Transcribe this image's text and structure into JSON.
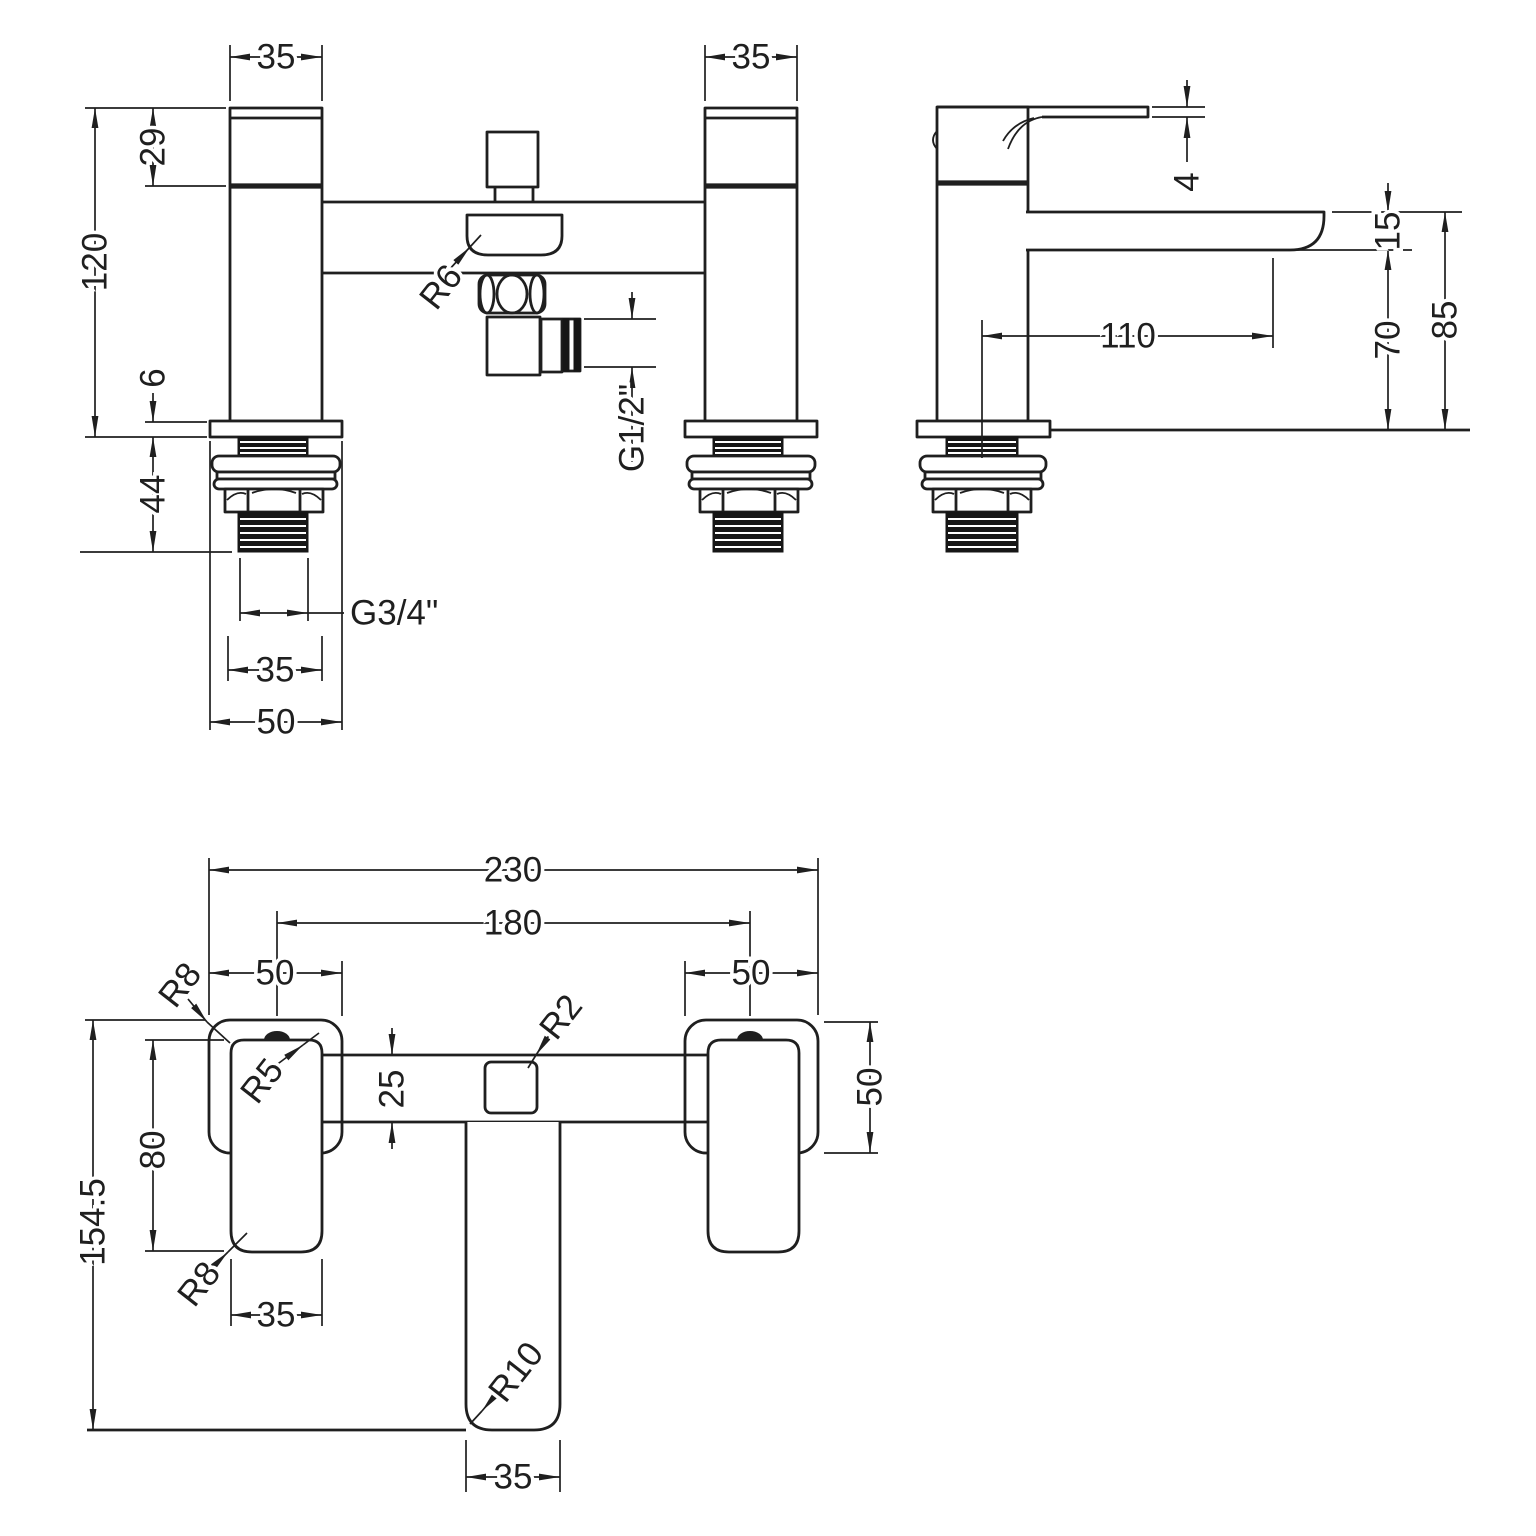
{
  "colors": {
    "line": "#1f1f1f",
    "background": "#ffffff"
  },
  "front_view": {
    "dim_left_body_width": "35",
    "dim_right_body_width": "35",
    "dim_handle_height": "29",
    "dim_height_to_deck": "120",
    "dim_deck_plate_thickness": "6",
    "dim_shank_length": "44",
    "shank_thread_label": "G3/4\"",
    "dim_shank_width": "35",
    "dim_flange_width": "50",
    "outlet_radius_label": "R6",
    "hose_thread_label": "G1/2\""
  },
  "side_view": {
    "dim_handle_thickness": "4",
    "dim_spout_thickness": "15",
    "dim_spout_reach": "110",
    "dim_spout_underside_height": "70",
    "dim_spout_top_height": "85"
  },
  "plan_view": {
    "dim_overall_width": "230",
    "dim_hole_centres": "180",
    "dim_left_escutcheon_width": "50",
    "dim_right_escutcheon_width": "50",
    "dim_escutcheon_depth": "50",
    "dim_handle_length": "80",
    "dim_overall_depth": "154.5",
    "dim_handle_width": "35",
    "dim_body_bar_width": "25",
    "dim_spout_width": "35",
    "escutcheon_radius_top_label": "R8",
    "escutcheon_radius_bottom_label": "R8",
    "handle_radius_label": "R5",
    "diverter_radius_label": "R2",
    "spout_radius_label": "R10"
  }
}
